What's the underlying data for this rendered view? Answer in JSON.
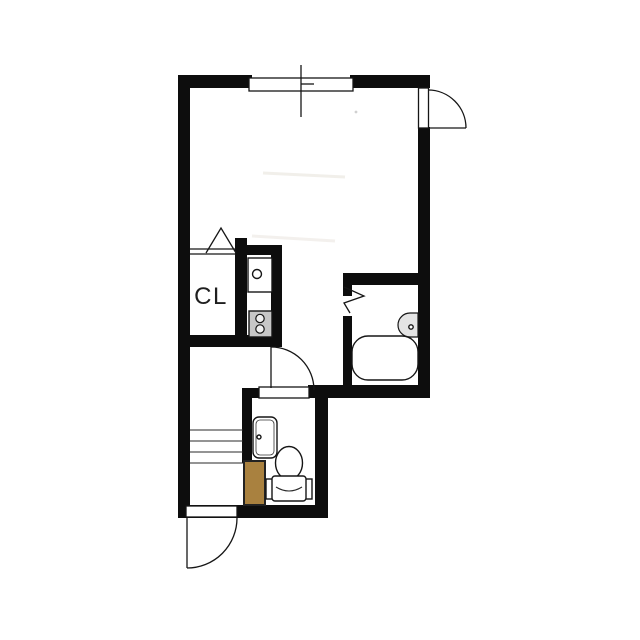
{
  "labels": {
    "closet": "CL"
  },
  "colors": {
    "background": "#ffffff",
    "wall": "#0d0d0d",
    "door_panel_brown": "#a9813f",
    "stove_gray": "#c7c7c7",
    "burner_fill": "#f0f0f0",
    "heater_gray": "#e4e4e4"
  },
  "fixtures": {
    "window": "sliding-window",
    "entry_door_right": "outward-swing-door",
    "entry_door_bottom": "outward-swing-door",
    "closet_door": "folding-door-triangle",
    "bathroom_door": "folding-door-zigzag",
    "hall_door": "swing-door",
    "kitchen": [
      "sink",
      "two-burner-stove"
    ],
    "bathroom": [
      "bathtub",
      "water-heater-unit"
    ],
    "toilet_room": [
      "washbasin",
      "toilet"
    ],
    "stairs": "step-lines"
  }
}
